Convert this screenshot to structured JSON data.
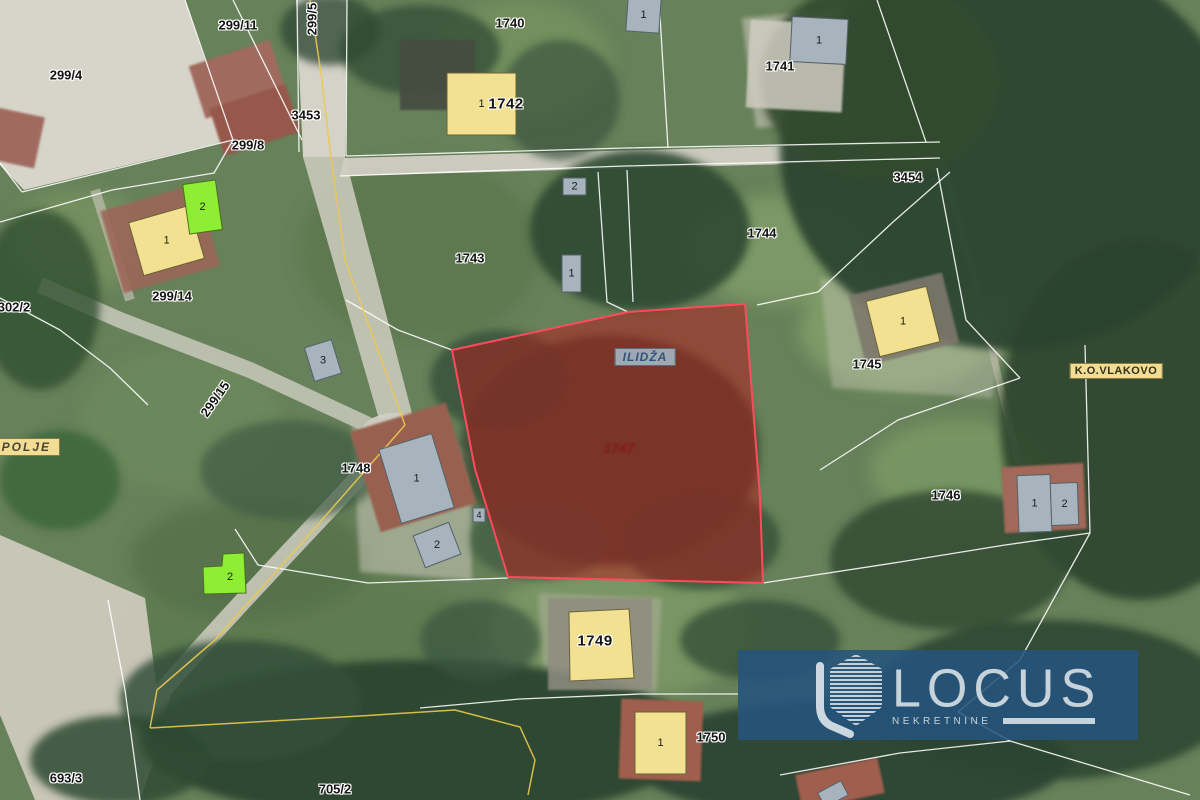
{
  "map": {
    "selected_parcel": {
      "number": "1747",
      "points": "452,350 628,312 745,304 760,497 763,583 508,577 475,469",
      "fill": "rgba(178,26,26,0.52)",
      "stroke": "#ff4a5e",
      "label_x": 619,
      "label_y": 448
    },
    "region_labels": [
      {
        "text": "299/4",
        "x": 66,
        "y": 75
      },
      {
        "text": "299/11",
        "x": 238,
        "y": 25
      },
      {
        "text": "299/5",
        "x": 312,
        "y": 19,
        "rot": -90
      },
      {
        "text": "3453",
        "x": 306,
        "y": 115
      },
      {
        "text": "299/8",
        "x": 248,
        "y": 145
      },
      {
        "text": "299/14",
        "x": 172,
        "y": 296
      },
      {
        "text": "302/2",
        "x": 14,
        "y": 307
      },
      {
        "text": "299/15",
        "x": 215,
        "y": 399,
        "rot": -55
      },
      {
        "text": "1740",
        "x": 510,
        "y": 23
      },
      {
        "text": "1742",
        "x": 506,
        "y": 104,
        "variant": "bold"
      },
      {
        "text": "1741",
        "x": 780,
        "y": 66
      },
      {
        "text": "3454",
        "x": 908,
        "y": 177
      },
      {
        "text": "1743",
        "x": 470,
        "y": 258
      },
      {
        "text": "1744",
        "x": 762,
        "y": 233
      },
      {
        "text": "1745",
        "x": 867,
        "y": 364
      },
      {
        "text": "1746",
        "x": 946,
        "y": 495
      },
      {
        "text": "1748",
        "x": 356,
        "y": 468
      },
      {
        "text": "1749",
        "x": 595,
        "y": 641,
        "variant": "bold"
      },
      {
        "text": "1750",
        "x": 711,
        "y": 737
      },
      {
        "text": "693/3",
        "x": 66,
        "y": 778
      },
      {
        "text": "705/2",
        "x": 335,
        "y": 789
      }
    ],
    "boxed_labels": [
      {
        "text": "ILIDŽA",
        "x": 645,
        "y": 357,
        "style": "municipality"
      },
      {
        "text": "K.O.VLAKOVO",
        "x": 1116,
        "y": 371,
        "style": "cadastre"
      },
      {
        "text": "O POLJE",
        "x": 18,
        "y": 447,
        "style": "cadastre-italic"
      }
    ],
    "buildings": [
      {
        "label": "1",
        "color": "yellow",
        "x": 447,
        "y": 73,
        "w": 69,
        "h": 62,
        "rot": 0
      },
      {
        "label": "1",
        "color": "yellow",
        "x": 135,
        "y": 213,
        "w": 63,
        "h": 55,
        "rot": -16
      },
      {
        "label": "2",
        "color": "green",
        "x": 186,
        "y": 182,
        "w": 33,
        "h": 50,
        "rot": -8
      },
      {
        "label": "1",
        "color": "yellow",
        "x": 872,
        "y": 293,
        "w": 62,
        "h": 57,
        "rot": -14
      },
      {
        "label": "",
        "color": "yellow",
        "points": "569,612 629,609 634,678 570,681"
      },
      {
        "label": "1",
        "color": "yellow",
        "x": 635,
        "y": 712,
        "w": 51,
        "h": 62,
        "rot": 0
      },
      {
        "label": "2",
        "color": "green",
        "points": "223,554 244,553 246,593 204,594 203,567 222,566",
        "lx": 230,
        "ly": 577
      },
      {
        "label": "1",
        "color": "gray",
        "x": 791,
        "y": 18,
        "w": 56,
        "h": 45,
        "rot": 3
      },
      {
        "label": "1",
        "color": "gray",
        "x": 627,
        "y": -2,
        "w": 33,
        "h": 34,
        "rot": 4
      },
      {
        "label": "2",
        "color": "gray",
        "x": 563,
        "y": 178,
        "w": 23,
        "h": 17,
        "rot": 0
      },
      {
        "label": "1",
        "color": "gray",
        "x": 562,
        "y": 255,
        "w": 19,
        "h": 37,
        "rot": 0
      },
      {
        "label": "3",
        "color": "gray",
        "x": 309,
        "y": 343,
        "w": 28,
        "h": 35,
        "rot": -17
      },
      {
        "label": "1",
        "color": "gray",
        "x": 389,
        "y": 440,
        "w": 55,
        "h": 77,
        "rot": -17
      },
      {
        "label": "2",
        "color": "gray",
        "x": 418,
        "y": 528,
        "w": 38,
        "h": 34,
        "rot": -21
      },
      {
        "label": "4",
        "color": "gray",
        "x": 473,
        "y": 508,
        "w": 12,
        "h": 14,
        "rot": 0,
        "small": true
      },
      {
        "label": "1",
        "color": "gray",
        "x": 1018,
        "y": 475,
        "w": 33,
        "h": 57,
        "rot": -2
      },
      {
        "label": "2",
        "color": "gray",
        "x": 1051,
        "y": 483,
        "w": 27,
        "h": 42,
        "rot": -2
      },
      {
        "label": "",
        "color": "gray",
        "x": 820,
        "y": 786,
        "w": 26,
        "h": 16,
        "rot": -28
      }
    ],
    "building_colors": {
      "yellow": {
        "fill": "#f1e190",
        "stroke": "#6b6136"
      },
      "green": {
        "fill": "#8dee33",
        "stroke": "#49721c"
      },
      "gray": {
        "fill": "#a7b4bd",
        "stroke": "#55626b"
      }
    }
  },
  "watermark": {
    "brand": "LOCUS",
    "subtitle": "NEKRETNINE",
    "bg": "rgba(37,84,126,0.87)",
    "fg": "#c7d3db"
  }
}
